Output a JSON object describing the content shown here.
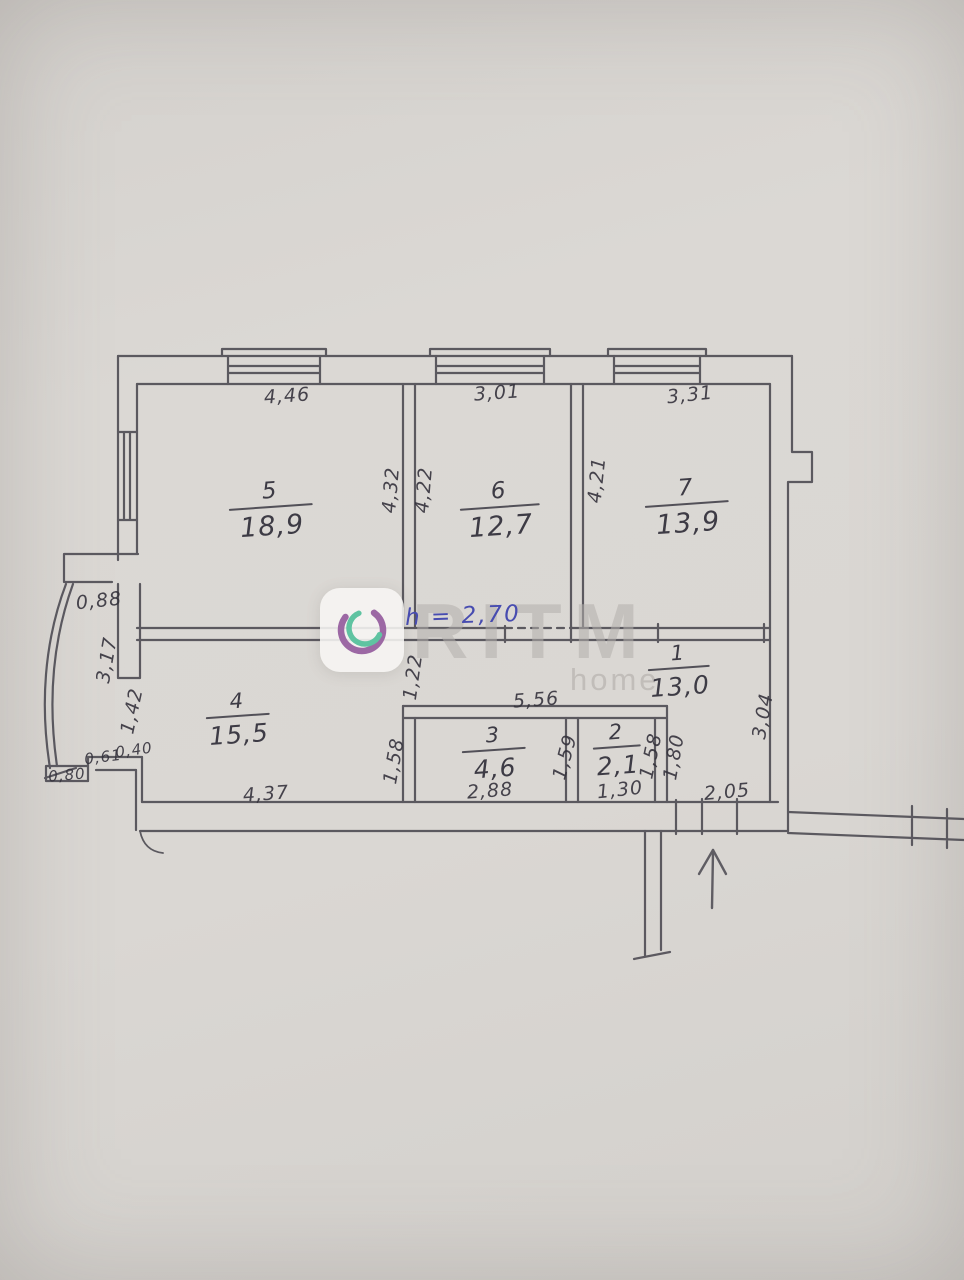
{
  "plan": {
    "note_height": "h = 2,70",
    "rooms": {
      "r1": {
        "number": "1",
        "area": "13,0"
      },
      "r2": {
        "number": "2",
        "area": "2,1"
      },
      "r3": {
        "number": "3",
        "area": "4,6"
      },
      "r4": {
        "number": "4",
        "area": "15,5"
      },
      "r5": {
        "number": "5",
        "area": "18,9"
      },
      "r6": {
        "number": "6",
        "area": "12,7"
      },
      "r7": {
        "number": "7",
        "area": "13,9"
      }
    },
    "dimensions": {
      "room5_top": "4,46",
      "room6_top": "3,01",
      "room7_top": "3,31",
      "room5_side": "4,32",
      "room6_side": "4,22",
      "room7_side": "4,21",
      "hall_strip": "1,22",
      "hall_top": "5,56",
      "bay_top": "0,88",
      "bay_wall": "3,17",
      "bay_opening": "1,42",
      "step_left": "0,61",
      "step_right": "0,40",
      "bay_bottom": "0,80",
      "room4_bottom": "4,37",
      "room4_side": "1,58",
      "room3_bottom": "2,88",
      "room3_side": "1,59",
      "room2_bottom": "1,30",
      "room2_side": "1,58",
      "hall_side": "1,80",
      "hall_right": "3,04",
      "entry_bottom": "2,05"
    }
  },
  "watermark": {
    "brand": "RITM",
    "word": "home"
  },
  "colors": {
    "paper": "#d9d6d2",
    "ink": "#4a4850",
    "note_blue": "#474cb0",
    "watermark_gray": "#b2afab",
    "logo_purple": "#9c68a4",
    "logo_teal": "#5fc3a1"
  }
}
